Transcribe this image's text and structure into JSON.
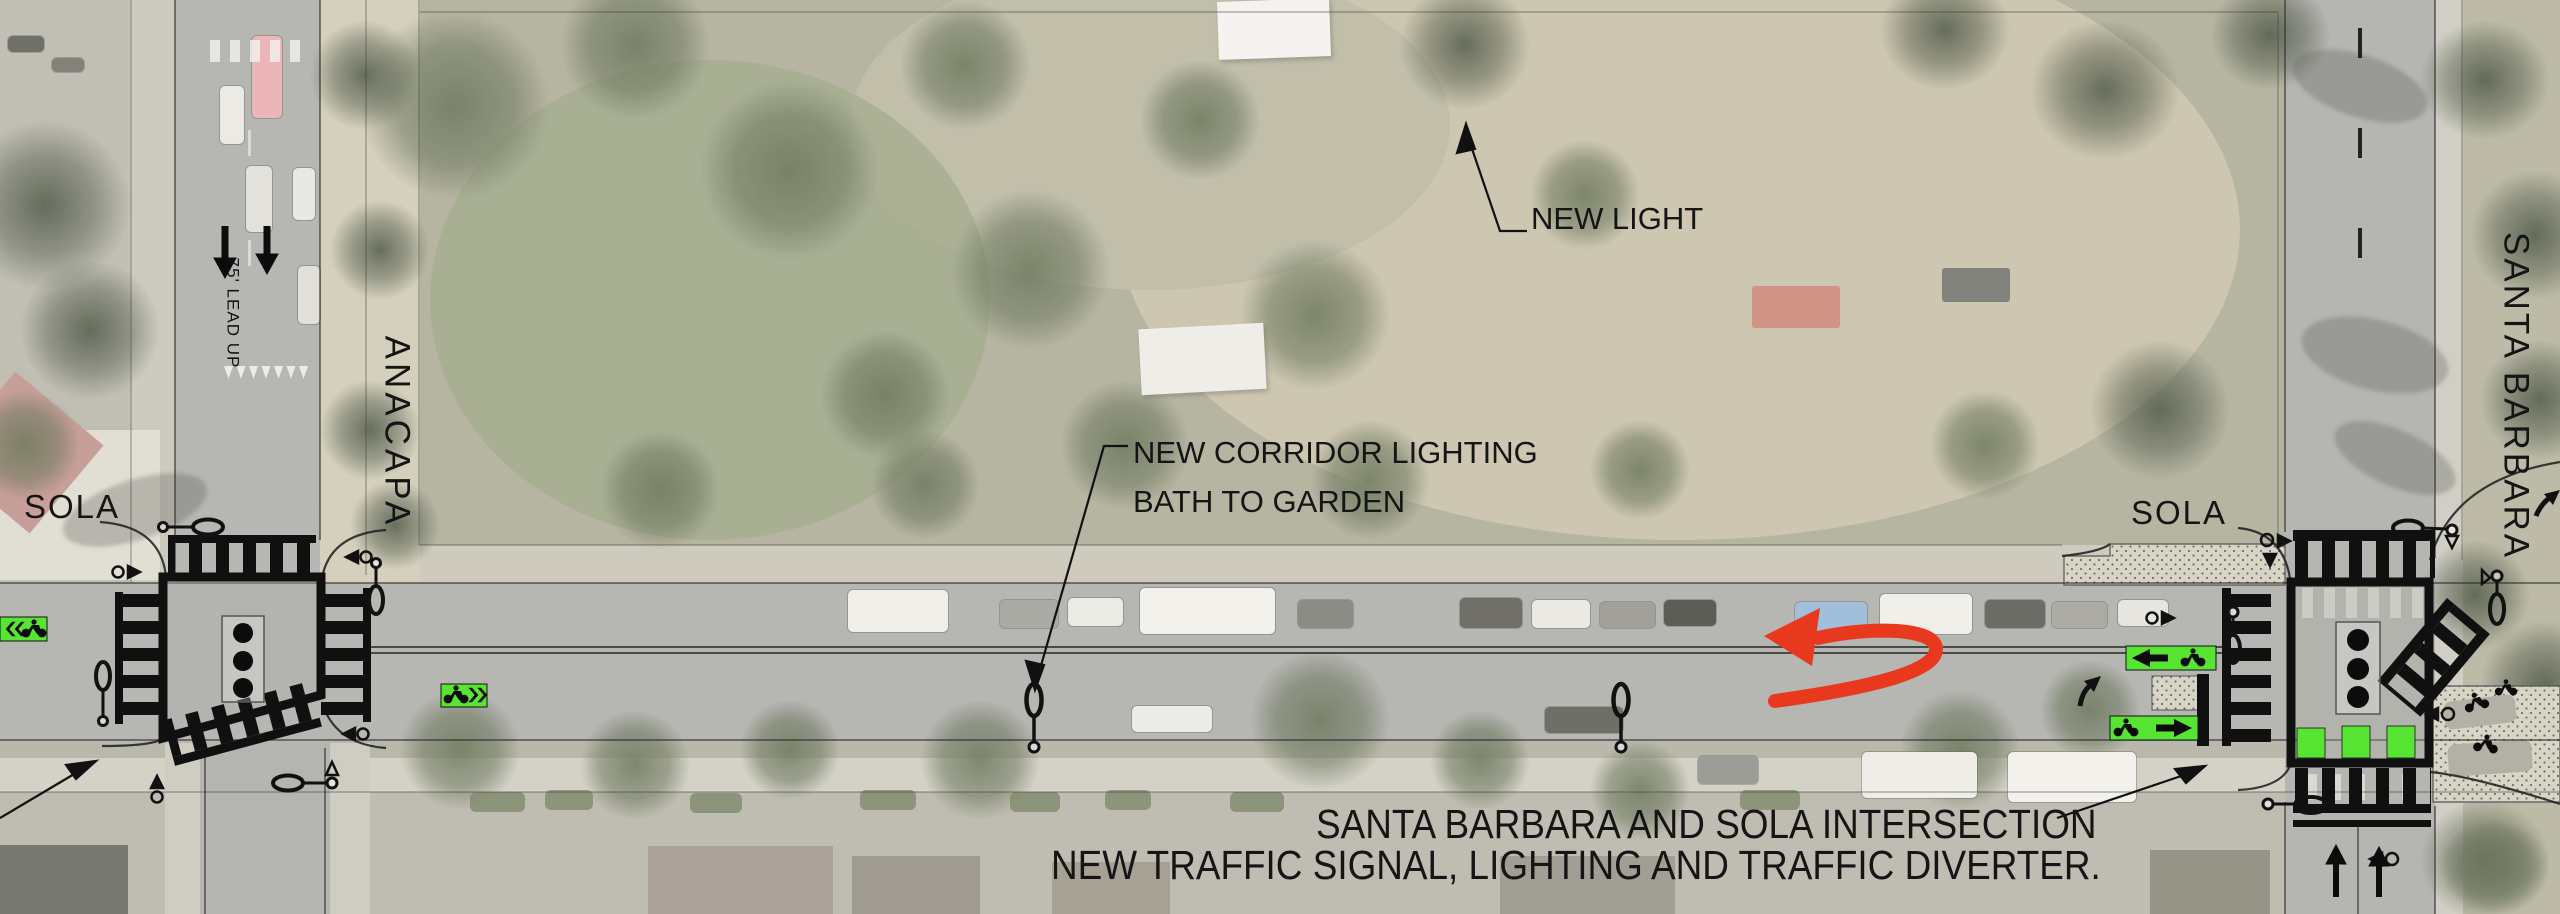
{
  "document": {
    "type": "traffic-improvement-plan-aerial",
    "streets": {
      "sola_left": "SOLA",
      "anacapa": "ANACAPA",
      "sola_right": "SOLA",
      "santa_barbara": "SANTA BARBARA"
    },
    "annotations": {
      "lead_up": "75' LEAD UP",
      "new_light": "NEW LIGHT",
      "corridor_line1": "NEW CORRIDOR LIGHTING",
      "corridor_line2": "BATH TO GARDEN",
      "note_line1": "SANTA BARBARA AND SOLA INTERSECTION",
      "note_line2": "NEW TRAFFIC SIGNAL, LIGHTING AND TRAFFIC DIVERTER."
    },
    "colors": {
      "annotation_ink": "#111111",
      "highlight_red": "#E8391F",
      "bike_lane_green": "#57E433",
      "road_gray": "#A8A8A4",
      "new_concrete_stipple": "#D8D4C6"
    },
    "icons": [
      {
        "name": "street-light-icon",
        "shape": "pole-with-ellipse-luminaire"
      },
      {
        "name": "traffic-signal-icon",
        "shape": "three-dot-signal-head"
      },
      {
        "name": "crosswalk-ladder-icon",
        "shape": "striped-ladder"
      },
      {
        "name": "bike-lane-marker-icon",
        "shape": "green-box-bike-chevrons"
      },
      {
        "name": "pedestrian-arrow-icon",
        "shape": "circle-with-triangle"
      },
      {
        "name": "turn-movement-arrow-red",
        "shape": "curved-red-arrow"
      },
      {
        "name": "lane-direction-arrow",
        "shape": "straight-black-arrow"
      }
    ]
  }
}
